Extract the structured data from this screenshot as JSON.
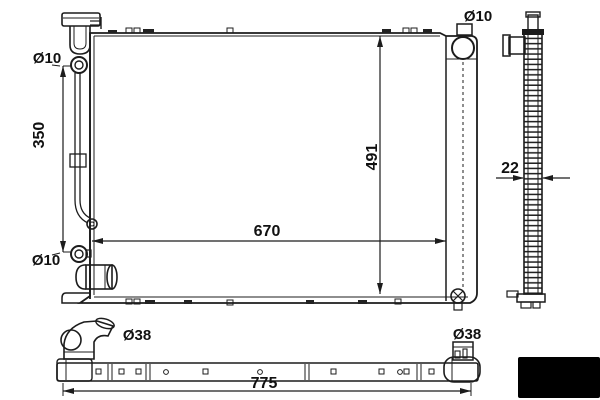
{
  "views": {
    "front": {
      "hole_top_left": "Ø10",
      "hole_bottom_left": "Ø10",
      "hole_top_right": "Ø10",
      "left_hole_span": "350",
      "core_width": "670",
      "core_height": "491"
    },
    "side": {
      "thickness": "22"
    },
    "bottom": {
      "left_pipe_dia": "Ø38",
      "right_pipe_dia": "Ø38",
      "overall_length": "775"
    }
  },
  "colors": {
    "line": "#1c1c1c",
    "background": "#ffffff",
    "logo_box": "#000000"
  }
}
